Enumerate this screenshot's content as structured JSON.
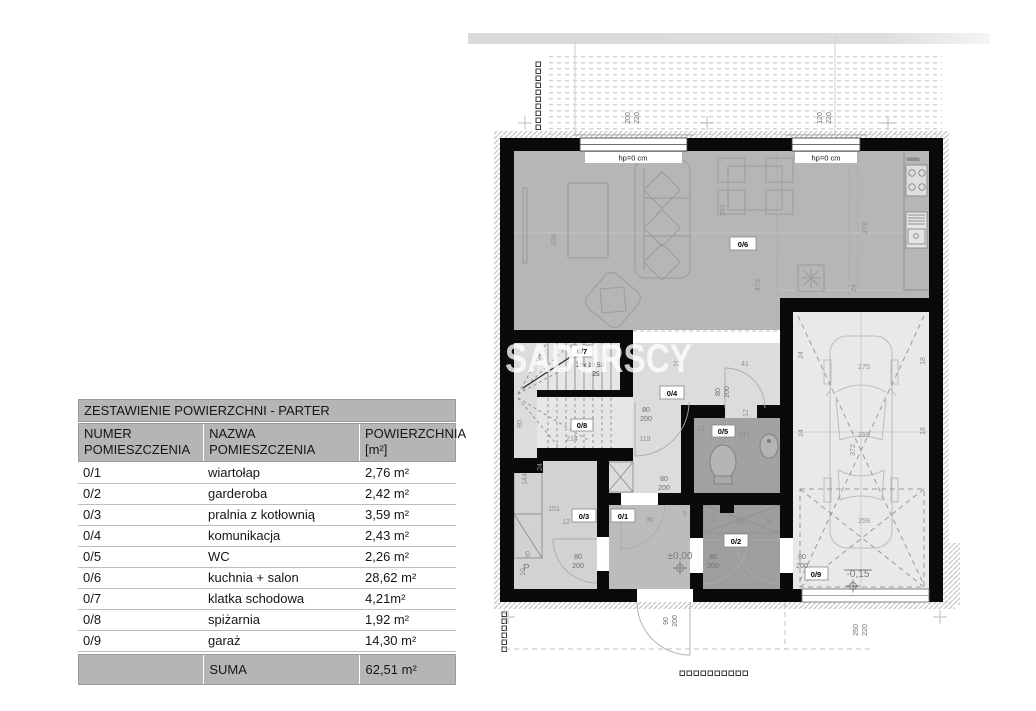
{
  "table": {
    "title": "ZESTAWIENIE POWIERZCHNI - PARTER",
    "headers": [
      {
        "l1": "NUMER",
        "l2": "POMIESZCZENIA"
      },
      {
        "l1": "NAZWA",
        "l2": "POMIESZCZENIA"
      },
      {
        "l1": "POWIERZCHNIA",
        "l2": "[m²]"
      }
    ],
    "rows": [
      [
        "0/1",
        "wiartołap",
        "2,76 m²"
      ],
      [
        "0/2",
        "garderoba",
        "2,42 m²"
      ],
      [
        "0/3",
        "pralnia z kotłownią",
        "3,59 m²"
      ],
      [
        "0/4",
        "komunikacja",
        "2,43 m²"
      ],
      [
        "0/5",
        "WC",
        "2,26 m²"
      ],
      [
        "0/6",
        "kuchnia + salon",
        "28,62 m²"
      ],
      [
        "0/7",
        "klatka schodowa",
        "4,21m²"
      ],
      [
        "0/8",
        "spiżarnia",
        "1,92 m²"
      ],
      [
        "0/9",
        "garaż",
        "14,30 m²"
      ]
    ],
    "suma_label": "SUMA",
    "suma_value": "62,51 m²"
  },
  "plan": {
    "watermark": "SADURSCY",
    "rooms": {
      "r1": "0/1",
      "r2": "0/2",
      "r3": "0/3",
      "r4": "0/4",
      "r5": "0/5",
      "r6": "0/6",
      "r7": "0/7",
      "r8": "0/8",
      "r9": "0/9"
    },
    "openings": {
      "hp": "hp=0 cm",
      "win1_w": "200",
      "win1_h": "220",
      "win2_w": "120",
      "win2_h": "220",
      "garage_w": "250",
      "garage_h": "220",
      "entry_w": "90",
      "entry_h": "200",
      "door_w": "80",
      "door_h": "200"
    },
    "levels": {
      "zero": "±0,00",
      "garage": "-0,15"
    },
    "stairs": {
      "formula": "16x 18,53",
      "tread": "25"
    },
    "p_label": "P",
    "dims": {
      "d338": "338",
      "d473": "473",
      "d291": "291",
      "d278": "278",
      "d275": "275",
      "d259": "259",
      "d372": "372",
      "d214": "214",
      "d151": "151",
      "d150": "150",
      "d144": "144",
      "d141": "141",
      "d119": "119",
      "d90": "90",
      "d65": "65",
      "d41": "41",
      "d24": "24",
      "d22": "22",
      "d18": "18",
      "d12": "12",
      "d10": "10",
      "d5": "5"
    }
  }
}
